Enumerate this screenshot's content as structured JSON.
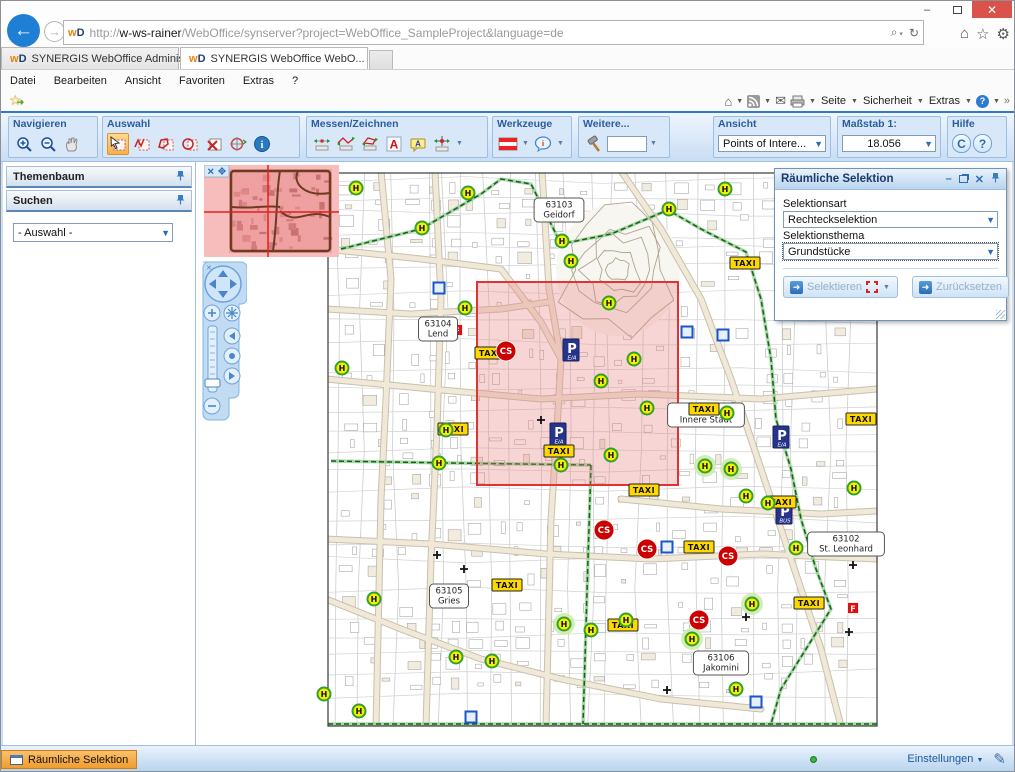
{
  "browser": {
    "url": {
      "prefix": "http://",
      "host": "w-ws-rainer",
      "path": "/WebOffice/synserver?project=WebOffice_SampleProject&language=de"
    },
    "favicon_text": {
      "w": "w",
      "d": "D"
    },
    "tabs": [
      {
        "title": "SYNERGIS WebOffice Administ..."
      },
      {
        "title": "SYNERGIS WebOffice WebO...",
        "close": "✕"
      }
    ],
    "menu": [
      "Datei",
      "Bearbeiten",
      "Ansicht",
      "Favoriten",
      "Extras",
      "?"
    ],
    "command_bar": {
      "seite": "Seite",
      "sicherheit": "Sicherheit",
      "extras": "Extras",
      "overflow": "»",
      "help": "?"
    },
    "window_controls": {
      "minimize": "–",
      "close": "✕"
    },
    "url_icons": {
      "search": "⌕",
      "refresh": "↻",
      "home": "⌂",
      "star": "☆",
      "gear": "⚙",
      "back": "←",
      "forward": "→",
      "mail": "✉"
    }
  },
  "toolbar": {
    "navigieren": "Navigieren",
    "auswahl": "Auswahl",
    "messen": "Messen/Zeichnen",
    "werkzeuge": "Werkzeuge",
    "weitere": "Weitere...",
    "ansicht": "Ansicht",
    "ansicht_value": "Points of Intere...",
    "masstab": "Maßstab 1:",
    "masstab_value": "18.056",
    "hilfe": "Hilfe",
    "hilfe_c": "C",
    "hilfe_q": "?"
  },
  "sidebar": {
    "themenbaum": "Themenbaum",
    "suchen": "Suchen",
    "auswahl_placeholder": "- Auswahl -"
  },
  "dialog": {
    "title": "Räumliche Selektion",
    "selektionsart_label": "Selektionsart",
    "selektionsart_value": "Rechteckselektion",
    "selektionsthema_label": "Selektionsthema",
    "selektionsthema_value": "Grundstücke",
    "selektieren_label": "Selektieren",
    "zuruecksetzen_label": "Zurücksetzen"
  },
  "statusbar": {
    "tab": "Räumliche Selektion",
    "einstellungen": "Einstellungen"
  },
  "map": {
    "marker_labels": {
      "stop": "H",
      "taxi": "TAXI",
      "cs": "CS",
      "parking": "P",
      "f": "F"
    },
    "selection": {
      "x": 280,
      "y": 120,
      "w": 201,
      "h": 203,
      "fill": "rgba(231,128,128,0.33)",
      "stroke": "#e03434"
    },
    "colors": {
      "stop_fill": "#f2ef00",
      "stop_ring": "#33a02c",
      "taxi_fill": "#ffd800",
      "cs_fill": "#cc0000",
      "parking_fill": "#27348b",
      "f_fill": "#e01010",
      "boundary": "#1e5c1e"
    },
    "districts": [
      {
        "lines": [
          "63103",
          "Geidorf"
        ],
        "x": 362,
        "y": 48
      },
      {
        "lines": [
          "63104",
          "Lend"
        ],
        "x": 241,
        "y": 167
      },
      {
        "lines": [
          "63101",
          "Innere Stadt"
        ],
        "x": 509,
        "y": 253
      },
      {
        "lines": [
          "63102",
          "St. Leonhard"
        ],
        "x": 649,
        "y": 382
      },
      {
        "lines": [
          "63105",
          "Gries"
        ],
        "x": 252,
        "y": 434
      },
      {
        "lines": [
          "63106",
          "Jakomini"
        ],
        "x": 524,
        "y": 501
      }
    ],
    "h_stops": [
      [
        159,
        26
      ],
      [
        271,
        31
      ],
      [
        365,
        79
      ],
      [
        472,
        47
      ],
      [
        528,
        27
      ],
      [
        649,
        29
      ],
      [
        225,
        66
      ],
      [
        268,
        146
      ],
      [
        374,
        99
      ],
      [
        412,
        141
      ],
      [
        437,
        197
      ],
      [
        404,
        219
      ],
      [
        145,
        206
      ],
      [
        249,
        268
      ],
      [
        242,
        301
      ],
      [
        364,
        303
      ],
      [
        414,
        293
      ],
      [
        450,
        246
      ],
      [
        508,
        304
      ],
      [
        534,
        307
      ],
      [
        530,
        251
      ],
      [
        657,
        326
      ],
      [
        599,
        386
      ],
      [
        549,
        334
      ],
      [
        571,
        341
      ],
      [
        177,
        437
      ],
      [
        259,
        495
      ],
      [
        295,
        499
      ],
      [
        367,
        462
      ],
      [
        394,
        468
      ],
      [
        429,
        458
      ],
      [
        495,
        477
      ],
      [
        555,
        442
      ],
      [
        539,
        527
      ],
      [
        127,
        532
      ],
      [
        162,
        549
      ]
    ],
    "h_halos": [
      [
        508,
        304
      ],
      [
        534,
        307
      ],
      [
        495,
        477
      ],
      [
        555,
        442
      ],
      [
        367,
        462
      ]
    ],
    "taxi": [
      [
        548,
        101
      ],
      [
        293,
        191
      ],
      [
        256,
        267
      ],
      [
        362,
        289
      ],
      [
        507,
        247
      ],
      [
        664,
        257
      ],
      [
        447,
        328
      ],
      [
        584,
        340
      ],
      [
        502,
        385
      ],
      [
        310,
        423
      ],
      [
        426,
        463
      ],
      [
        612,
        441
      ]
    ],
    "cs": [
      [
        309,
        189
      ],
      [
        407,
        368
      ],
      [
        450,
        387
      ],
      [
        531,
        394
      ],
      [
        502,
        458
      ]
    ],
    "parking": [
      {
        "x": 374,
        "y": 188,
        "sub": "E/A"
      },
      {
        "x": 361,
        "y": 272,
        "sub": "E/A"
      },
      {
        "x": 584,
        "y": 275,
        "sub": "E/A"
      },
      {
        "x": 587,
        "y": 351,
        "sub": "BUS"
      }
    ],
    "f_badges": [
      [
        260,
        168
      ],
      [
        656,
        446
      ]
    ],
    "blue_squares": [
      [
        242,
        126
      ],
      [
        490,
        170
      ],
      [
        526,
        173
      ],
      [
        470,
        385
      ],
      [
        274,
        555
      ],
      [
        559,
        540
      ]
    ],
    "crosses": [
      [
        344,
        258
      ],
      [
        240,
        393
      ],
      [
        267,
        407
      ],
      [
        656,
        403
      ],
      [
        549,
        455
      ],
      [
        470,
        528
      ],
      [
        652,
        470
      ]
    ]
  }
}
